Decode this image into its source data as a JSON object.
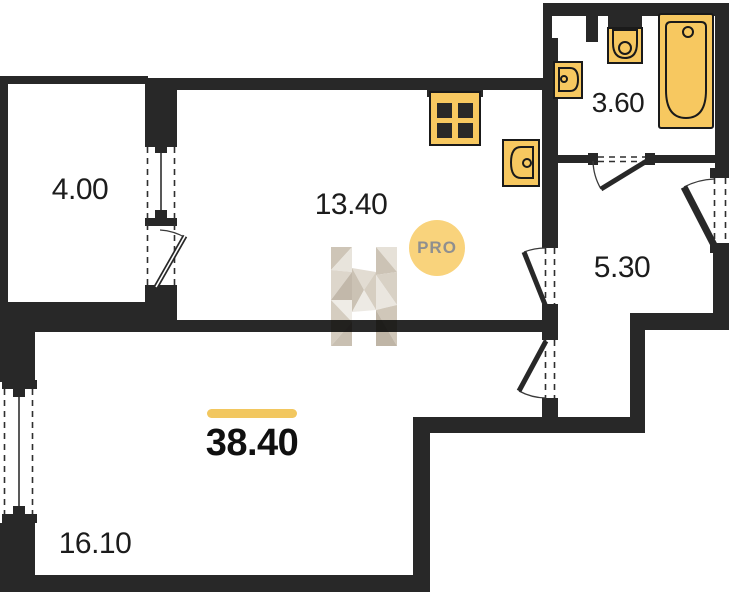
{
  "plan": {
    "badge": {
      "label": "PRO"
    },
    "total": {
      "area_label": "38.40"
    },
    "rooms": [
      {
        "name": "balcony",
        "area_label": "4.00"
      },
      {
        "name": "kitchen-living",
        "area_label": "13.40"
      },
      {
        "name": "bathroom",
        "area_label": "3.60"
      },
      {
        "name": "hallway",
        "area_label": "5.30"
      },
      {
        "name": "bedroom",
        "area_label": "16.10"
      }
    ],
    "icons": [
      "bathtub-icon",
      "toilet-icon",
      "washbasin-icon",
      "kitchen-sink-icon",
      "stove-icon",
      "door-swing-icon",
      "window-icon",
      "h-logo-watermark"
    ],
    "colors": {
      "wall": "#282828",
      "fixture_fill": "#F7C860",
      "fixture_border": "#1a1a1a",
      "accent_bar": "#F2C75F",
      "pro_circle": "#F9D37C",
      "pro_text": "#8F8F8F",
      "label_text": "#1c1c1c",
      "line": "#2f2f2f"
    }
  }
}
